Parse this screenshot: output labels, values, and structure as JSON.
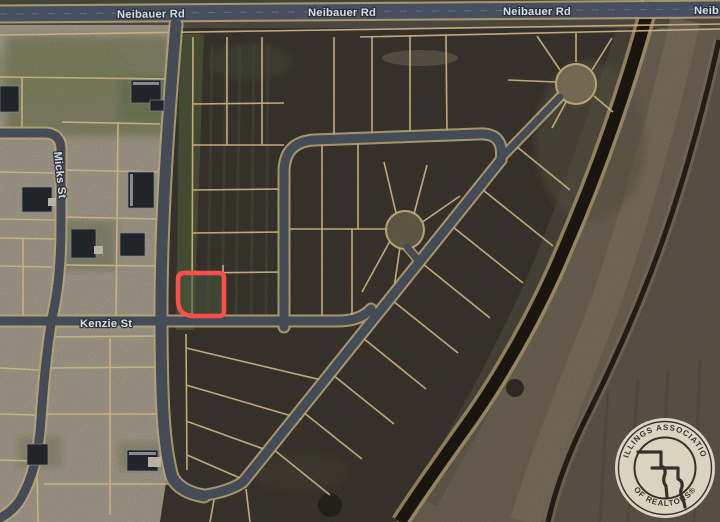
{
  "map": {
    "street_labels": {
      "neibauer": "Neibauer Rd",
      "neibauer_partial": "Neib",
      "micks": "Micks St",
      "kenzie": "Kenzie St"
    },
    "watermark": {
      "arc_top": "BILLINGS ASSOCIATION",
      "arc_bottom": "OF REALTORS®"
    },
    "highlight": {
      "shape": "lot-outline"
    },
    "colors": {
      "highlight": "#ff4843",
      "lot_line": "#c9ae7c",
      "road": "#3f4650",
      "road_major": "#424a58",
      "road_edge": "#b49c6e",
      "canal": "#17130e",
      "label_text": "#dde5ee",
      "watermark_bg": "#eae3cd",
      "watermark_ink": "#2e2e27"
    }
  }
}
